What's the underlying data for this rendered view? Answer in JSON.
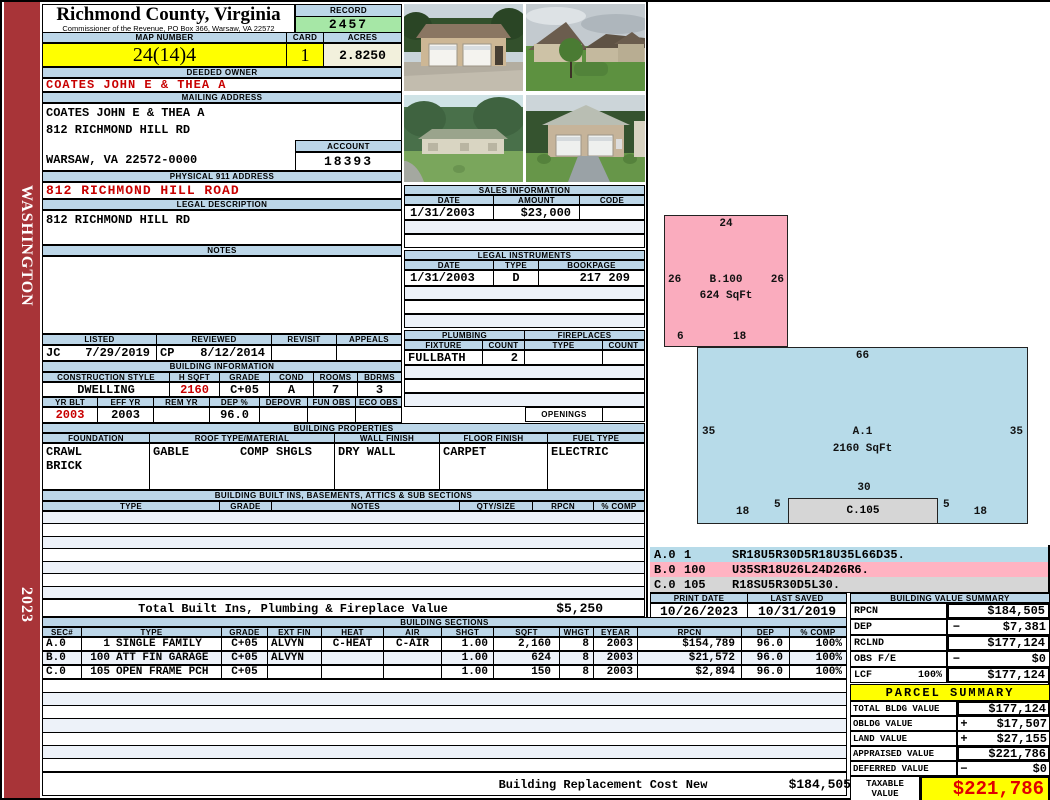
{
  "sidebar": {
    "state": "WASHINGTON",
    "year": "2023"
  },
  "header": {
    "title": "Richmond County, Virginia",
    "subtitle": "Commissioner of the Revenue, PO Box 366, Warsaw, VA 22572",
    "record_label": "RECORD",
    "record": "2457",
    "map_label": "MAP NUMBER",
    "map_number": "24(14)4",
    "card_label": "CARD",
    "card": "1",
    "acres_label": "ACRES",
    "acres": "2.8250"
  },
  "owner": {
    "deeded_label": "DEEDED OWNER",
    "name": "COATES JOHN E & THEA A",
    "mailing_label": "MAILING ADDRESS",
    "mail_line1": "COATES JOHN E & THEA A",
    "mail_line2": "812 RICHMOND HILL RD",
    "mail_line3": "WARSAW, VA 22572-0000",
    "account_label": "ACCOUNT",
    "account": "18393",
    "physical_label": "PHYSICAL 911 ADDRESS",
    "physical": "812 RICHMOND HILL ROAD",
    "legal_label": "LEGAL DESCRIPTION",
    "legal": "812 RICHMOND HILL RD",
    "notes_label": "NOTES"
  },
  "visits": {
    "cols": [
      "LISTED",
      "REVIEWED",
      "REVISIT",
      "APPEALS"
    ],
    "listed_by": "JC",
    "listed_date": "7/29/2019",
    "reviewed_by": "CP",
    "reviewed_date": "8/12/2014"
  },
  "building_info": {
    "title": "BUILDING INFORMATION",
    "cols1": [
      "CONSTRUCTION STYLE",
      "H SQFT",
      "GRADE",
      "COND",
      "ROOMS",
      "BDRMS"
    ],
    "style": "DWELLING",
    "hsqft": "2160",
    "grade": "C+05",
    "cond": "A",
    "rooms": "7",
    "bdrms": "3",
    "cols2": [
      "YR BLT",
      "EFF YR",
      "REM YR",
      "DEP %",
      "DEPOVR",
      "FUN OBS",
      "ECO OBS"
    ],
    "yr_blt": "2003",
    "eff_yr": "2003",
    "rem_yr": "",
    "dep_pct": "96.0",
    "depovr": "",
    "fun_obs": "",
    "eco_obs": ""
  },
  "building_props": {
    "title": "BUILDING PROPERTIES",
    "cols": [
      "FOUNDATION",
      "ROOF TYPE/MATERIAL",
      "WALL FINISH",
      "FLOOR FINISH",
      "FUEL TYPE"
    ],
    "foundation1": "CRAWL",
    "foundation2": "BRICK",
    "roof_type": "GABLE",
    "roof_material": "COMP SHGLS",
    "wall": "DRY WALL",
    "floor": "CARPET",
    "fuel": "ELECTRIC"
  },
  "built_ins": {
    "title": "BUILDING BUILT INS, BASEMENTS, ATTICS & SUB SECTIONS",
    "cols": [
      "TYPE",
      "GRADE",
      "NOTES",
      "QTY/SIZE",
      "RPCN",
      "% COMP"
    ],
    "total_label": "Total Built Ins, Plumbing & Fireplace Value",
    "total_value": "$5,250"
  },
  "sales": {
    "title": "SALES INFORMATION",
    "cols": [
      "DATE",
      "AMOUNT",
      "CODE"
    ],
    "rows": [
      {
        "date": "1/31/2003",
        "amount": "$23,000",
        "code": ""
      }
    ]
  },
  "instruments": {
    "title": "LEGAL INSTRUMENTS",
    "cols": [
      "DATE",
      "TYPE",
      "BOOKPAGE"
    ],
    "rows": [
      {
        "date": "1/31/2003",
        "type": "D",
        "bookpage": "217 209"
      }
    ]
  },
  "plumbing": {
    "title": "PLUMBING",
    "cols": [
      "FIXTURE",
      "COUNT"
    ],
    "rows": [
      {
        "fixture": "FULLBATH",
        "count": "2"
      }
    ]
  },
  "fireplaces": {
    "title": "FIREPLACES",
    "cols": [
      "TYPE",
      "COUNT"
    ],
    "openings_label": "OPENINGS"
  },
  "sketch": {
    "b": {
      "name": "B.100",
      "sqft": "624 SqFt",
      "top": "24",
      "left": "26",
      "right": "26",
      "bottom_left": "6",
      "bottom_center": "18"
    },
    "a": {
      "name": "A.1",
      "sqft": "2160 SqFt",
      "top": "66",
      "left": "35",
      "right": "35",
      "inner": "30",
      "bottom_left": "18",
      "bottom_right": "18",
      "porch_left": "5",
      "porch_right": "5"
    },
    "c": {
      "name": "C.105"
    },
    "codes": [
      {
        "sec": "A.0",
        "num": "1",
        "code": "SR18U5R30D5R18U35L66D35."
      },
      {
        "sec": "B.0",
        "num": "100",
        "code": "U35SR18U26L24D26R6."
      },
      {
        "sec": "C.0",
        "num": "105",
        "code": "R18SU5R30D5L30."
      }
    ]
  },
  "print_info": {
    "print_date_label": "PRINT DATE",
    "print_date": "10/26/2023",
    "last_saved_label": "LAST SAVED",
    "last_saved": "10/31/2019"
  },
  "building_value_summary": {
    "title": "BUILDING VALUE SUMMARY",
    "rows": [
      {
        "label": "RPCN",
        "pct": "",
        "sign": "",
        "value": "$184,505"
      },
      {
        "label": "DEP",
        "pct": "",
        "sign": "−",
        "value": "$7,381"
      },
      {
        "label": "RCLND",
        "pct": "",
        "sign": "",
        "value": "$177,124"
      },
      {
        "label": "OBS F/E",
        "pct": "",
        "sign": "−",
        "value": "$0"
      },
      {
        "label": "LCF",
        "pct": "100%",
        "sign": "",
        "value": "$177,124"
      }
    ]
  },
  "sections": {
    "title": "BUILDING SECTIONS",
    "cols": [
      "SEC#",
      "TYPE",
      "GRADE",
      "EXT FIN",
      "HEAT",
      "AIR",
      "SHGT",
      "SQFT",
      "WHGT",
      "EYEAR",
      "RPCN",
      "DEP",
      "% COMP"
    ],
    "rows": [
      {
        "sec": "A.0",
        "no": "1",
        "type": "SINGLE FAMILY",
        "grade": "C+05",
        "ext": "ALVYN",
        "heat": "C-HEAT",
        "air": "C-AIR",
        "shgt": "1.00",
        "sqft": "2,160",
        "whgt": "8",
        "eyear": "2003",
        "rpcn": "$154,789",
        "dep": "96.0",
        "comp": "100%"
      },
      {
        "sec": "B.0",
        "no": "100",
        "type": "ATT FIN GARAGE",
        "grade": "C+05",
        "ext": "ALVYN",
        "heat": "",
        "air": "",
        "shgt": "1.00",
        "sqft": "624",
        "whgt": "8",
        "eyear": "2003",
        "rpcn": "$21,572",
        "dep": "96.0",
        "comp": "100%"
      },
      {
        "sec": "C.0",
        "no": "105",
        "type": "OPEN FRAME PCH",
        "grade": "C+05",
        "ext": "",
        "heat": "",
        "air": "",
        "shgt": "1.00",
        "sqft": "150",
        "whgt": "8",
        "eyear": "2003",
        "rpcn": "$2,894",
        "dep": "96.0",
        "comp": "100%"
      }
    ],
    "footer_label": "Building Replacement Cost New",
    "footer_value": "$184,505"
  },
  "parcel_summary": {
    "title": "PARCEL SUMMARY",
    "rows": [
      {
        "label": "TOTAL BLDG VALUE",
        "sign": "",
        "value": "$177,124"
      },
      {
        "label": "OBLDG VALUE",
        "sign": "+",
        "value": "$17,507"
      },
      {
        "label": "LAND VALUE",
        "sign": "+",
        "value": "$27,155"
      },
      {
        "label": "APPRAISED VALUE",
        "sign": "",
        "value": "$221,786"
      },
      {
        "label": "DEFERRED VALUE",
        "sign": "−",
        "value": "$0"
      }
    ],
    "taxable_label_1": "TAXABLE",
    "taxable_label_2": "VALUE",
    "taxable_value": "$221,786"
  }
}
